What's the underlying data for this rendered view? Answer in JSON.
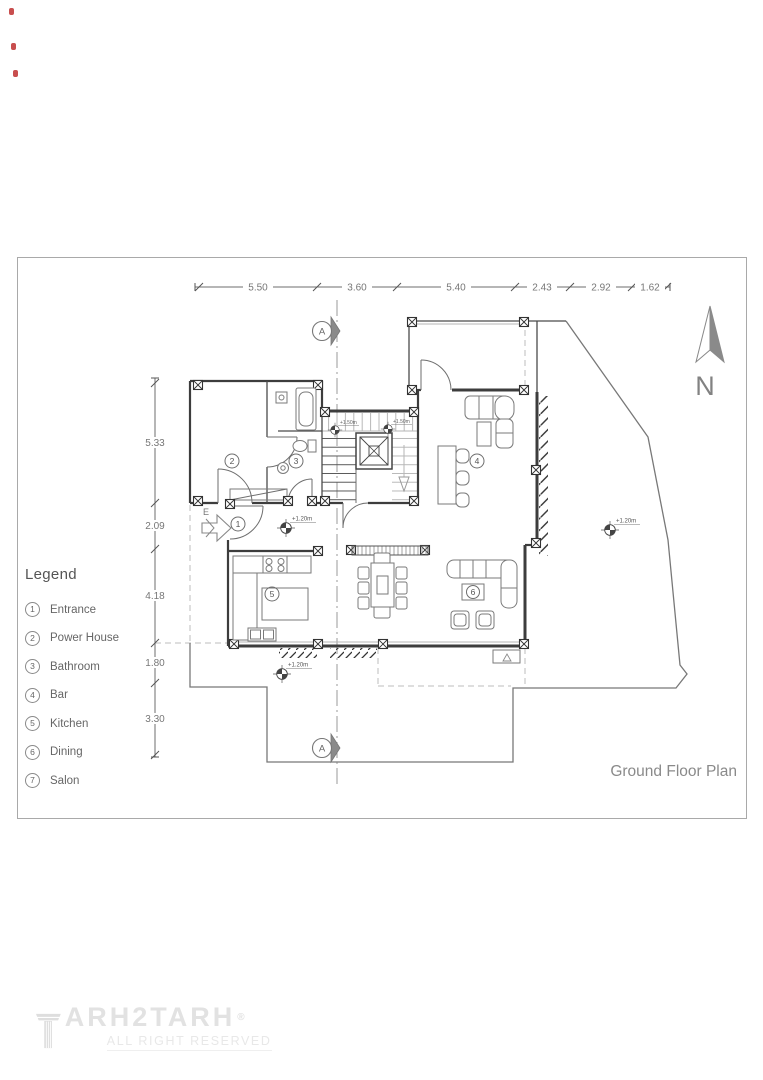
{
  "title": "Ground Floor Plan",
  "compass": {
    "north_label": "N"
  },
  "section": {
    "label": "A"
  },
  "dimensions": {
    "top": [
      "5.50",
      "3.60",
      "5.40",
      "2.43",
      "2.92",
      "1.62"
    ],
    "left": [
      "5.33",
      "2.09",
      "4.18",
      "1.80",
      "3.30"
    ]
  },
  "legend": {
    "title": "Legend",
    "items": [
      {
        "num": "1",
        "label": "Entrance"
      },
      {
        "num": "2",
        "label": "Power House"
      },
      {
        "num": "3",
        "label": "Bathroom"
      },
      {
        "num": "4",
        "label": "Bar"
      },
      {
        "num": "5",
        "label": "Kitchen"
      },
      {
        "num": "6",
        "label": "Dining"
      },
      {
        "num": "7",
        "label": "Salon"
      }
    ]
  },
  "plan": {
    "tags": {
      "entrance": "1",
      "power_house": "2",
      "bathroom": "3",
      "bar": "4",
      "kitchen": "5",
      "dining": "6"
    },
    "entrance_direction_label": "E",
    "levels": {
      "hall": "+1.20m",
      "south": "+1.20m",
      "yard": "+1.20m",
      "stair_left": "+1.50m",
      "stair_right": "+1.50m"
    }
  },
  "footer": {
    "brand": "ARH2TARH",
    "registered": "®",
    "tagline": "ALL RIGHT RESERVED"
  },
  "colors": {
    "accent_red": "#c23b3b",
    "drawing_dark": "#3d3d3d",
    "drawing_gray": "#b5b5b5",
    "text_gray": "#666666",
    "logo_gray": "#e2e2e2"
  }
}
